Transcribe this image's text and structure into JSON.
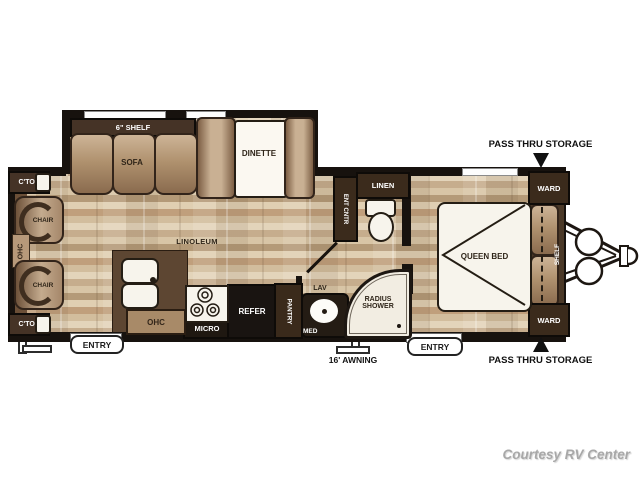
{
  "watermark": "Courtesy RV Center",
  "exterior": {
    "pass_thru_top": "PASS THRU STORAGE",
    "pass_thru_bottom": "PASS THRU STORAGE",
    "awning": "16' AWNING",
    "entry_left": "ENTRY",
    "entry_right": "ENTRY"
  },
  "living": {
    "shelf": "6\" SHELF",
    "sofa": "SOFA",
    "dinette": "DINETTE",
    "chair_top": "CHAIR",
    "chair_bottom": "CHAIR",
    "ctop_top": "C'TOP",
    "ctop_bottom": "C'TOP",
    "ohc_left": "OHC",
    "floor": "LINOLEUM"
  },
  "kitchen": {
    "ohc": "OHC",
    "micro": "MICRO",
    "refer": "REFER",
    "pantry": "PANTRY"
  },
  "bath": {
    "lav": "LAV",
    "med": "MED",
    "shower": "RADIUS SHOWER",
    "linen": "LINEN",
    "ent_cntr": "ENT CNTR"
  },
  "bedroom": {
    "bed": "QUEEN BED",
    "ward_top": "WARD",
    "ward_bottom": "WARD",
    "shelf": "SHELF"
  }
}
